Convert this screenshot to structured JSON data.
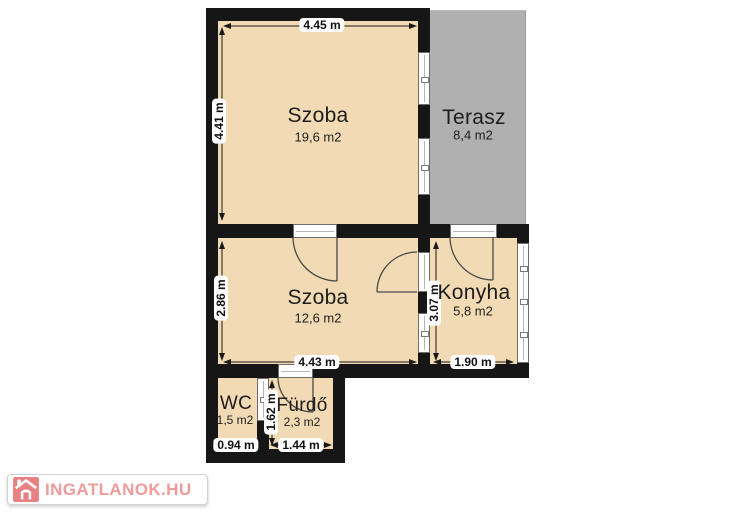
{
  "plan": {
    "type": "floorplan",
    "colors": {
      "floor": "#f2dbb4",
      "terrace": "#b0b0b0",
      "wall": "#161616",
      "background": "#ffffff",
      "logo_red": "#e88181",
      "logo_text": "#f09b9b"
    },
    "rooms": [
      {
        "name": "Szoba",
        "area": "19,6 m2"
      },
      {
        "name": "Terasz",
        "area": "8,4 m2"
      },
      {
        "name": "Szoba",
        "area": "12,6 m2"
      },
      {
        "name": "Konyha",
        "area": "5,8 m2"
      },
      {
        "name": "WC",
        "area": "1,5 m2"
      },
      {
        "name": "Fürdő",
        "area": "2,3 m2"
      }
    ],
    "dimensions": [
      {
        "label": "4.45 m",
        "orientation": "horizontal",
        "edge": "szoba1-top"
      },
      {
        "label": "4.41 m",
        "orientation": "vertical",
        "edge": "szoba1-left"
      },
      {
        "label": "2.86 m",
        "orientation": "vertical",
        "edge": "szoba2-left"
      },
      {
        "label": "4.43 m",
        "orientation": "horizontal",
        "edge": "szoba2-bottom"
      },
      {
        "label": "3.07 m",
        "orientation": "vertical",
        "edge": "konyha-left"
      },
      {
        "label": "1.90 m",
        "orientation": "horizontal",
        "edge": "konyha-bottom"
      },
      {
        "label": "1.62 m",
        "orientation": "vertical",
        "edge": "furdo-left"
      },
      {
        "label": "0.94 m",
        "orientation": "horizontal",
        "edge": "wc-bottom"
      },
      {
        "label": "1.44 m",
        "orientation": "horizontal",
        "edge": "furdo-bottom"
      }
    ]
  },
  "watermark": {
    "text": "INGATLANOK.HU"
  }
}
